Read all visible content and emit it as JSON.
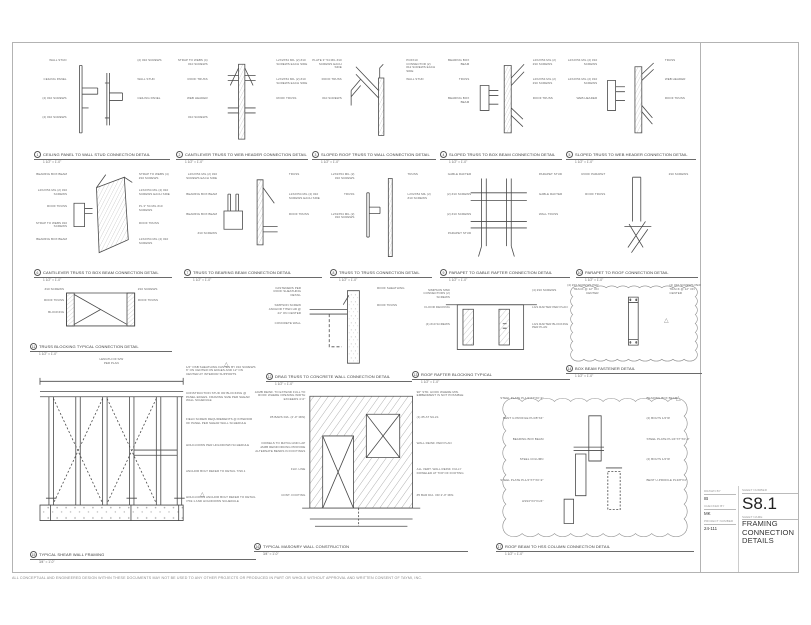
{
  "icons": {
    "revision_triangle": "△"
  },
  "title_block": {
    "sheet_number_label": "SHEET NUMBER",
    "sheet_number": "S8.1",
    "sheet_name_label": "SHEET NAME",
    "sheet_name": "FRAMING CONNECTION DETAILS",
    "drawn_by_label": "DRAWN BY",
    "drawn_by": "IB",
    "checked_by_label": "CHECKED BY",
    "checked_by": "MK",
    "project_number_label": "PROJECT NUMBER",
    "project_number": "24-111"
  },
  "disclaimer": "ALL CONCEPTUAL AND ENGINEERED DESIGN WITHIN THESE DOCUMENTS MAY NOT BE USED TO ANY OTHER PROJECTS OR PRODUCED IN PART OR WHOLE WITHOUT APPROVAL AND WRITTEN CONSENT OF TAYMI, INC.",
  "details": [
    {
      "num": "1",
      "title": "CEILING PANEL TO WALL STUD CONNECTION DETAIL",
      "scale": "1 1/2\" = 1'-0\"",
      "labels": [
        "WALL STUD",
        "(2) #10 SCREWS",
        "CEILING PANEL",
        "WALL STUD",
        "(2) #10 SCREWS",
        "CEILING PANEL",
        "(2) #10 SCREWS"
      ]
    },
    {
      "num": "2",
      "title": "CANTILEVER TRUSS TO WEB HEADER CONNECTION DETAIL",
      "scale": "1 1/2\" = 1'-0\"",
      "labels": [
        "STRAP TO WEBS (4) #10 SCREWS",
        "L2X2X54 MIL (2) #10 SCREWS EACH SIDE",
        "ROOF TRUSS",
        "L2X2X54 MIL (2) #10 SCREWS EACH SIDE",
        "WEB HEADER",
        "ROOF TRUSS",
        "#10 SCREWS"
      ]
    },
    {
      "num": "3",
      "title": "SLOPED ROOF TRUSS TO WALL CONNECTION DETAIL",
      "scale": "1 1/2\" = 1'-0\"",
      "labels": [
        "PLATE 3\" 54 MIL #10 SCREWS EACH SIDE",
        "PC6X10 CONNECTOR (2) #12 SCREWS EACH SIDE",
        "ROOF TRUSS",
        "WALL STUD",
        "#10 SCREWS"
      ]
    },
    {
      "num": "4",
      "title": "SLOPED TRUSS TO BOX BEAM CONNECTION DETAIL",
      "scale": "1 1/2\" = 1'-0\"",
      "labels": [
        "BEARING BOX BEAM",
        "L2X2X54 MIL (2) #10 SCREWS",
        "TRUSS",
        "L2X2X54 MIL (2) #10 SCREWS",
        "BEARING BOX BEAM",
        "ROOF TRUSS"
      ]
    },
    {
      "num": "5",
      "title": "SLOPED TRUSS TO WEB HEADER CONNECTION DETAIL",
      "scale": "1 1/2\" = 1'-0\"",
      "labels": [
        "L2X2X54 MIL (2) #10 SCREWS",
        "TRUSS",
        "L2X2X54 MIL (2) #10 SCREWS",
        "WEB HEADER",
        "WEB HEADER",
        "ROOF TRUSS"
      ]
    },
    {
      "num": "6",
      "title": "CANTILEVER TRUSS TO BOX BEAM CONNECTION DETAIL",
      "scale": "1 1/2\" = 1'-0\"",
      "labels": [
        "BEARING BOX BEAM",
        "STRAP TO WEBS (4) #10 SCREWS",
        "L2X2X54 MIL (2) #10 SCREWS",
        "L2X2X54 MIL (2) #10 SCREWS EACH SIDE",
        "ROOF TRUSS",
        "PL 3\" 54 MIL #10 SCREWS",
        "STRAP TO WEBS #10 SCREWS",
        "ROOF TRUSS",
        "BEARING BOX BEAM",
        "L2X2X54 MIL (2) #10 SCREWS"
      ]
    },
    {
      "num": "7",
      "title": "TRUSS TO BEARING BEAM CONNECTION DETAIL",
      "scale": "1 1/2\" = 1'-0\"",
      "labels": [
        "L2X2X54 MIL (2) #10 SCREWS EACH SIDE",
        "TRUSS",
        "BEARING BOX BEAM",
        "L2X2X54 MIL (2) #10 SCREWS EACH SIDE",
        "BEARING BOX BEAM",
        "ROOF TRUSS",
        "#10 SCREWS"
      ]
    },
    {
      "num": "8",
      "title": "TRUSS TO TRUSS CONNECTION DETAIL",
      "scale": "1 1/2\" = 1'-0\"",
      "labels": [
        "L2X2X54 MIL (2) #10 SCREWS",
        "TRUSS",
        "TRUSS",
        "L2X2X54 MIL (2) #10 SCREWS",
        "L2X2X54 MIL (2) #10 SCREWS"
      ]
    },
    {
      "num": "9",
      "title": "PARAPET TO GABLE RAFTER CONNECTION DETAIL",
      "scale": "1 1/2\" = 1'-0\"",
      "labels": [
        "GABLE RAFTER",
        "PARAPET STUD",
        "(2) #10 SCREWS",
        "GABLE RAFTER",
        "(2) #10 SCREWS",
        "WALL TRUSS",
        "PARAPET STUD"
      ]
    },
    {
      "num": "10",
      "title": "PARAPET TO ROOF CONNECTION DETAIL",
      "scale": "1 1/2\" = 1'-0\"",
      "labels": [
        "ROOF PARAPET",
        "#10 SCREWS",
        "ROOF TRUSS"
      ]
    },
    {
      "num": "11",
      "title": "TRUSS BLOCKING TYPICAL CONNECTION DETAIL",
      "scale": "1 1/2\" = 1'-0\"",
      "labels": [
        "#10 SCREWS",
        "#10 SCREWS",
        "ROOF TRUSS",
        "ROOF TRUSS",
        "BLOCKING"
      ]
    },
    {
      "num": "12",
      "title": "DRAG TRUSS TO CONCRETE WALL CONNECTION DETAIL",
      "scale": "1 1/2\" = 1'-0\"",
      "labels": [
        "FASTENERS PER ROOF SHEATHING DETAIL",
        "ROOF SHEATHING",
        "SIMPSON SCREW ANCHOR TITEN HD @ 24\" ON CENTER",
        "ROOF TRUSS",
        "CONCRETE WALL"
      ]
    },
    {
      "num": "13",
      "title": "ROOF RAFTER BLOCKING TYPICAL",
      "scale": "1 1/2\" = 1'-0\"",
      "labels": [
        "SIMPSON MSD CONNECTORS (2) SCREWS",
        "(4) #10 SCREWS",
        "FLOOR DECKING",
        "LGS RAFTER PER PLAN",
        "(4) #10 SCREWS",
        "LGS RAFTER BLOCKING PER PLAN"
      ]
    },
    {
      "num": "14",
      "title": "BOX BEAM FASTENER DETAIL",
      "scale": "1 1/2\" = 1'-0\"",
      "labels": [
        "(4) #10 SCREWS PER TRACK @ 12\" ON CENTER",
        "(4) #10 SCREWS PER TRACK @ 12\" ON CENTER"
      ]
    },
    {
      "num": "15",
      "title": "TYPICAL SHEAR WALL FRAMING",
      "scale": "3/4\" = 1'-0\"",
      "dim_label": "LENGTH OF S/W",
      "dim_sub": "PER PLAN",
      "labels": [
        "1/2\" OSB SHEATHING FASTEN BY #10 SCREWS 6\" ON CENTER ON EDGES AND 12\" ON CENTER AT INTERIOR SUPPORTS",
        "CONSTRUCTION STUD OR BLOCKING @ PANEL EDGES. FRAMING SIZE PER SHEAR WALL SCHEDULE",
        "FIELD SCREW REQUIREMENTS @ INTERIOR OF PANEL PER SHEAR WALL SCHEDULE",
        "HOLD-DOWN PER HOLDDOWN SCHEDULE",
        "ANCHOR BOLT REFER TO DETAIL 7/S9.1",
        "HOLD-DOWN ANCHOR BOLT REFER TO DETAIL 7/S9.1 AND HOLDDOWN SCHEDULE"
      ]
    },
    {
      "num": "16",
      "title": "TYPICAL MASONRY WALL CONSTRUCTION",
      "scale": "3/4\" = 1'-0\"",
      "labels": [
        "JAMB REINF. TO EXTEND FULL TO ROOF WHERE OPENING WIDTH EXCEEDS 4'-0\"",
        "90° STD. HOOK WHERE MIN. EMBEDMENT IS NOT POSSIBLE",
        "#5 BARS DIA. (2'-0\" MIN)",
        "(1) #5 AT SILLS",
        "DOWELS TO MATCH AND LAP JAMB REINFORCING PROVIDE ALTERNATE BENDS IN FOOTINGS",
        "WALL REINF. PER PLAN",
        "FLR. LINE",
        "ALL VERT. WALL REINF. FULLY DOWELED AT TOP OF FOOTING",
        "CONT. FOOTING",
        "#5 BAR DIA. OR 2'-0\" MIN."
      ]
    },
    {
      "num": "17",
      "title": "ROOF BEAM TO HSS COLUMN CONNECTION DETAIL",
      "scale": "1 1/2\" = 1'-0\"",
      "labels": [
        "STEEL PLATE PL1/4\"X7\"X0'-9\"",
        "BEARING BOX BEAM",
        "BENT U-PROFILE PL3/8\"X4\"",
        "(2) BOLTS 1/2\"Ø",
        "BEARING BOX BEAM",
        "STEEL PLATE PL1/4\"X7\"X0'-9\"",
        "STEEL COLUMN",
        "(2) BOLTS 1/2\"Ø",
        "STEEL PLATE PL1/4\"X7\"X0'-9\"",
        "BENT U-PROFILE PL3/8\"X4\"",
        "HSS3\"X3\"X1/4\""
      ]
    }
  ]
}
